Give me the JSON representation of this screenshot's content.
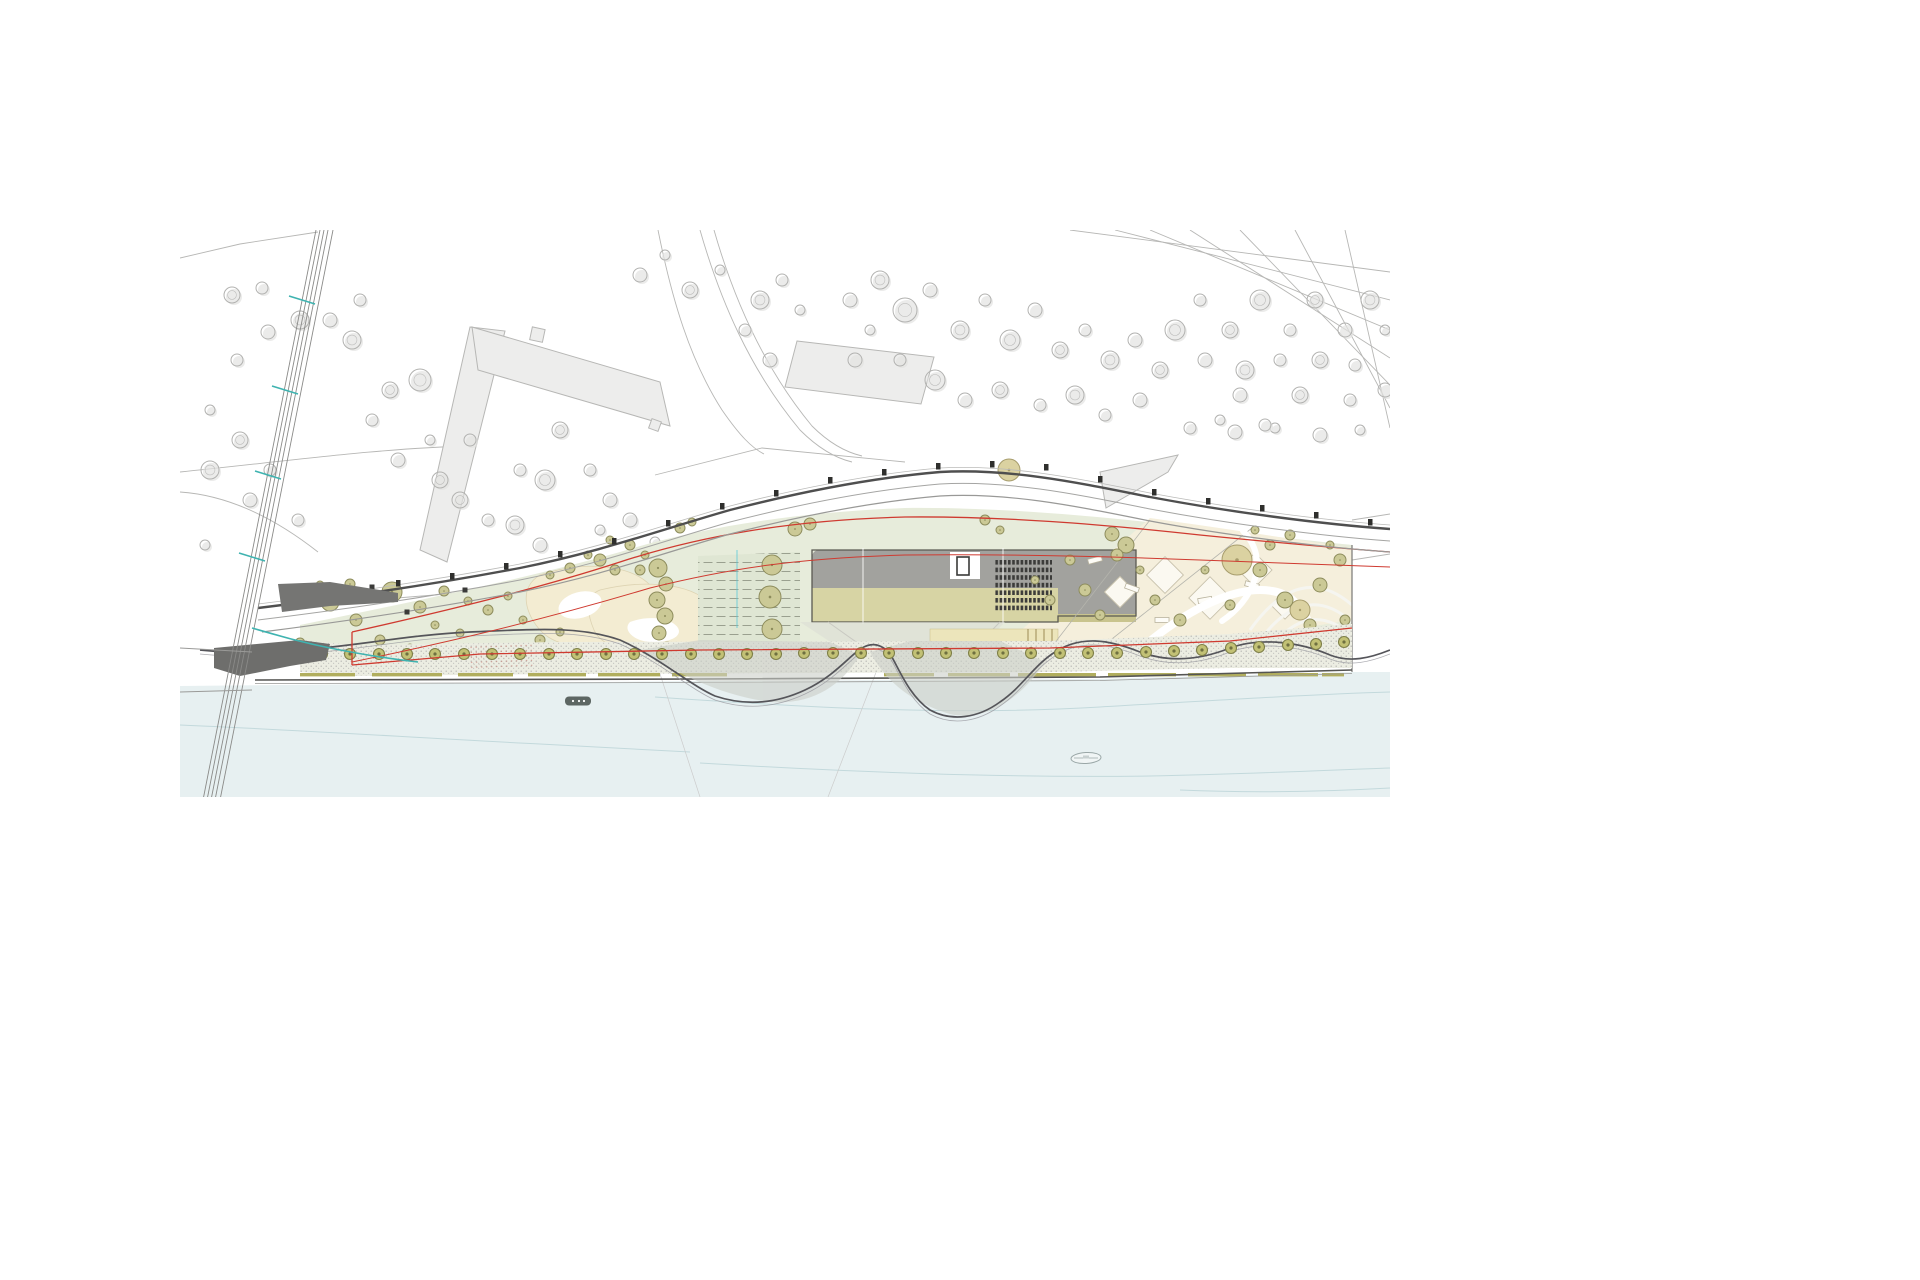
{
  "drawing": {
    "kind_label": "riverfront-park-site-plan",
    "palette": {
      "bg": "#ffffff",
      "water": "#e7f0f1",
      "waterline": "#c3d9dc",
      "green": "#e7ecdb",
      "green2": "#dfe6d3",
      "cream": "#f5efdc",
      "blob": "#f3ecd2",
      "khaki": "#c9c48e",
      "khaki2": "#d7d4a4",
      "roof": "#a2a29e",
      "roofedge": "#5a5952",
      "hatch": "#3c3c3a",
      "ctx": "#ededec",
      "ctxstroke": "#b7b7b5",
      "ctxtree": "#b2b2b0",
      "ctxtreeshadow": "#e3e3e1",
      "road": "#4f4f4f",
      "roadlight": "#a5a5a3",
      "red": "#cf3a30",
      "teal": "#3fb3b0",
      "olive": "#cbc996",
      "olivestroke": "#8d8c5c",
      "tan": "#dbd2a1",
      "tanstroke": "#a79d6d",
      "prom": "#ecede2",
      "promtree": "#c2c175",
      "promtreestroke": "#7f8049",
      "stippledot": "#acacaa",
      "dark": "#6e6e6c",
      "quaydash": "#b1ae5e",
      "rampgray": "#cbcec8",
      "yellowstrip": "#ece5bb"
    },
    "context_trees": [
      [
        232,
        295,
        8
      ],
      [
        262,
        288,
        6
      ],
      [
        300,
        320,
        9
      ],
      [
        268,
        332,
        7
      ],
      [
        237,
        360,
        6
      ],
      [
        210,
        410,
        5
      ],
      [
        240,
        440,
        8
      ],
      [
        270,
        470,
        6
      ],
      [
        210,
        470,
        9
      ],
      [
        250,
        500,
        7
      ],
      [
        298,
        520,
        6
      ],
      [
        205,
        545,
        5
      ],
      [
        330,
        320,
        7
      ],
      [
        360,
        300,
        6
      ],
      [
        352,
        340,
        9
      ],
      [
        390,
        390,
        8
      ],
      [
        420,
        380,
        11
      ],
      [
        372,
        420,
        6
      ],
      [
        398,
        460,
        7
      ],
      [
        430,
        440,
        5
      ],
      [
        460,
        500,
        8
      ],
      [
        488,
        520,
        6
      ],
      [
        515,
        525,
        9
      ],
      [
        540,
        545,
        7
      ],
      [
        560,
        430,
        8
      ],
      [
        590,
        470,
        6
      ],
      [
        610,
        500,
        7
      ],
      [
        545,
        480,
        10
      ],
      [
        520,
        470,
        6
      ],
      [
        600,
        530,
        5
      ],
      [
        630,
        520,
        7
      ],
      [
        655,
        542,
        5
      ],
      [
        470,
        440,
        6
      ],
      [
        440,
        480,
        8
      ],
      [
        640,
        275,
        7
      ],
      [
        665,
        255,
        5
      ],
      [
        690,
        290,
        8
      ],
      [
        720,
        270,
        5
      ],
      [
        760,
        300,
        9
      ],
      [
        782,
        280,
        6
      ],
      [
        745,
        330,
        6
      ],
      [
        770,
        360,
        7
      ],
      [
        800,
        310,
        5
      ],
      [
        850,
        300,
        7
      ],
      [
        880,
        280,
        9
      ],
      [
        905,
        310,
        12
      ],
      [
        930,
        290,
        7
      ],
      [
        960,
        330,
        9
      ],
      [
        985,
        300,
        6
      ],
      [
        1010,
        340,
        10
      ],
      [
        1035,
        310,
        7
      ],
      [
        1060,
        350,
        8
      ],
      [
        1085,
        330,
        6
      ],
      [
        1110,
        360,
        9
      ],
      [
        1135,
        340,
        7
      ],
      [
        1160,
        370,
        8
      ],
      [
        900,
        360,
        6
      ],
      [
        935,
        380,
        10
      ],
      [
        965,
        400,
        7
      ],
      [
        1000,
        390,
        8
      ],
      [
        1040,
        405,
        6
      ],
      [
        1075,
        395,
        9
      ],
      [
        1105,
        415,
        6
      ],
      [
        1140,
        400,
        7
      ],
      [
        870,
        330,
        5
      ],
      [
        855,
        360,
        7
      ],
      [
        1175,
        330,
        10
      ],
      [
        1200,
        300,
        6
      ],
      [
        1230,
        330,
        8
      ],
      [
        1260,
        300,
        10
      ],
      [
        1290,
        330,
        6
      ],
      [
        1315,
        300,
        8
      ],
      [
        1345,
        330,
        7
      ],
      [
        1370,
        300,
        9
      ],
      [
        1385,
        330,
        5
      ],
      [
        1205,
        360,
        7
      ],
      [
        1245,
        370,
        9
      ],
      [
        1280,
        360,
        6
      ],
      [
        1320,
        360,
        8
      ],
      [
        1355,
        365,
        6
      ],
      [
        1240,
        395,
        7
      ],
      [
        1300,
        395,
        8
      ],
      [
        1350,
        400,
        6
      ],
      [
        1385,
        390,
        7
      ],
      [
        1190,
        428,
        6
      ],
      [
        1235,
        432,
        7
      ],
      [
        1275,
        428,
        5
      ],
      [
        1320,
        435,
        7
      ],
      [
        1360,
        430,
        5
      ],
      [
        1220,
        420,
        5
      ],
      [
        1265,
        425,
        6
      ]
    ],
    "park_trees": [
      [
        330,
        602,
        9,
        "o"
      ],
      [
        356,
        620,
        6,
        "o"
      ],
      [
        392,
        592,
        10,
        "o"
      ],
      [
        420,
        607,
        6,
        "o"
      ],
      [
        300,
        643,
        5,
        "o"
      ],
      [
        444,
        591,
        5,
        "o"
      ],
      [
        468,
        601,
        4,
        "o"
      ],
      [
        350,
        584,
        5,
        "o"
      ],
      [
        320,
        585,
        4,
        "o"
      ],
      [
        435,
        625,
        4,
        "o"
      ],
      [
        460,
        633,
        4,
        "o"
      ],
      [
        488,
        610,
        5,
        "o"
      ],
      [
        508,
        596,
        4,
        "o"
      ],
      [
        523,
        620,
        4,
        "o"
      ],
      [
        380,
        640,
        5,
        "o"
      ],
      [
        410,
        648,
        4,
        "o"
      ],
      [
        658,
        568,
        9,
        "o"
      ],
      [
        666,
        584,
        7,
        "o"
      ],
      [
        657,
        600,
        8,
        "o"
      ],
      [
        665,
        616,
        8,
        "o"
      ],
      [
        659,
        633,
        7,
        "o"
      ],
      [
        667,
        648,
        6,
        "o"
      ],
      [
        649,
        652,
        4,
        "o"
      ],
      [
        676,
        654,
        4,
        "o"
      ],
      [
        640,
        570,
        5,
        "o"
      ],
      [
        645,
        555,
        4,
        "o"
      ],
      [
        772,
        565,
        10,
        "o"
      ],
      [
        770,
        597,
        11,
        "o"
      ],
      [
        772,
        629,
        10,
        "o"
      ],
      [
        758,
        650,
        4,
        "o"
      ],
      [
        746,
        648,
        4,
        "o"
      ],
      [
        783,
        650,
        4,
        "o"
      ],
      [
        795,
        529,
        7,
        "o"
      ],
      [
        810,
        524,
        6,
        "o"
      ],
      [
        680,
        528,
        5,
        "o"
      ],
      [
        692,
        522,
        4,
        "o"
      ],
      [
        540,
        640,
        5,
        "o"
      ],
      [
        560,
        632,
        4,
        "o"
      ],
      [
        600,
        560,
        6,
        "o"
      ],
      [
        615,
        570,
        5,
        "o"
      ],
      [
        588,
        555,
        4,
        "o"
      ],
      [
        630,
        545,
        5,
        "o"
      ],
      [
        610,
        540,
        4,
        "o"
      ],
      [
        570,
        568,
        5,
        "o"
      ],
      [
        550,
        575,
        4,
        "o"
      ],
      [
        1009,
        470,
        11,
        "t"
      ],
      [
        985,
        520,
        5,
        "o"
      ],
      [
        1000,
        530,
        4,
        "o"
      ],
      [
        1112,
        534,
        7,
        "o"
      ],
      [
        1126,
        545,
        8,
        "o"
      ],
      [
        1117,
        555,
        6,
        "o"
      ],
      [
        1070,
        560,
        5,
        "o"
      ],
      [
        1085,
        590,
        6,
        "o"
      ],
      [
        1100,
        615,
        5,
        "o"
      ],
      [
        1140,
        570,
        4,
        "o"
      ],
      [
        1155,
        600,
        5,
        "o"
      ],
      [
        1180,
        620,
        6,
        "o"
      ],
      [
        1205,
        570,
        4,
        "o"
      ],
      [
        1230,
        605,
        5,
        "o"
      ],
      [
        1237,
        560,
        15,
        "t"
      ],
      [
        1270,
        545,
        5,
        "o"
      ],
      [
        1300,
        610,
        10,
        "t"
      ],
      [
        1320,
        585,
        7,
        "o"
      ],
      [
        1260,
        570,
        7,
        "o"
      ],
      [
        1285,
        600,
        8,
        "o"
      ],
      [
        1310,
        625,
        6,
        "o"
      ],
      [
        1340,
        560,
        6,
        "o"
      ],
      [
        1345,
        620,
        5,
        "o"
      ],
      [
        1050,
        600,
        5,
        "o"
      ],
      [
        1035,
        580,
        4,
        "o"
      ],
      [
        1330,
        545,
        4,
        "o"
      ],
      [
        1255,
        530,
        4,
        "o"
      ],
      [
        1290,
        535,
        5,
        "o"
      ]
    ],
    "promenade_trees": [
      [
        322,
        654
      ],
      [
        350,
        654
      ],
      [
        379,
        654
      ],
      [
        407,
        654
      ],
      [
        435,
        654
      ],
      [
        464,
        654
      ],
      [
        492,
        654
      ],
      [
        520,
        654
      ],
      [
        549,
        654
      ],
      [
        577,
        654
      ],
      [
        606,
        654
      ],
      [
        634,
        654
      ],
      [
        662,
        654
      ],
      [
        691,
        654
      ],
      [
        719,
        654
      ],
      [
        747,
        654
      ],
      [
        776,
        654
      ],
      [
        804,
        653
      ],
      [
        833,
        653
      ],
      [
        861,
        653
      ],
      [
        889,
        653
      ],
      [
        918,
        653
      ],
      [
        946,
        653
      ],
      [
        974,
        653
      ],
      [
        1003,
        653
      ],
      [
        1031,
        653
      ],
      [
        1060,
        653
      ],
      [
        1088,
        653
      ],
      [
        1117,
        653
      ],
      [
        1146,
        652
      ],
      [
        1174,
        651
      ],
      [
        1202,
        650
      ],
      [
        1231,
        648
      ],
      [
        1259,
        647
      ],
      [
        1288,
        645
      ],
      [
        1316,
        644
      ],
      [
        1344,
        642
      ]
    ],
    "road_markers": [
      [
        398,
        588
      ],
      [
        452,
        581
      ],
      [
        506,
        571
      ],
      [
        560,
        559
      ],
      [
        614,
        546
      ],
      [
        668,
        528
      ],
      [
        722,
        511
      ],
      [
        776,
        498
      ],
      [
        830,
        485
      ],
      [
        884,
        477
      ],
      [
        938,
        471
      ],
      [
        992,
        469
      ],
      [
        1046,
        472
      ],
      [
        1100,
        484
      ],
      [
        1154,
        497
      ],
      [
        1208,
        506
      ],
      [
        1262,
        513
      ],
      [
        1316,
        520
      ],
      [
        1370,
        527
      ]
    ],
    "quay_dashes": [
      [
        300,
        55
      ],
      [
        372,
        70
      ],
      [
        458,
        55
      ],
      [
        528,
        58
      ],
      [
        598,
        62
      ],
      [
        672,
        55
      ],
      [
        884,
        50
      ],
      [
        948,
        62
      ],
      [
        1018,
        78
      ],
      [
        1108,
        68
      ],
      [
        1188,
        58
      ],
      [
        1258,
        60
      ],
      [
        1322,
        22
      ]
    ],
    "rail_ticks": [
      [
        302,
        300
      ],
      [
        285,
        390
      ],
      [
        268,
        475
      ],
      [
        252,
        557
      ]
    ],
    "street_furniture": [
      [
        320,
        602
      ],
      [
        372,
        587
      ],
      [
        407,
        612
      ],
      [
        465,
        590
      ]
    ],
    "plaza_diamonds": [
      [
        1120,
        592,
        22
      ],
      [
        1165,
        575,
        26
      ],
      [
        1210,
        598,
        30
      ],
      [
        1255,
        570,
        24
      ],
      [
        1285,
        605,
        20
      ]
    ],
    "plaza_benches": [
      [
        1095,
        560,
        -15
      ],
      [
        1132,
        588,
        20
      ],
      [
        1205,
        600,
        -10
      ],
      [
        1252,
        585,
        15
      ],
      [
        1162,
        620,
        0
      ]
    ],
    "boats": [
      {
        "x": 578,
        "y": 701,
        "w": 26,
        "h": 9,
        "style": "dark"
      },
      {
        "x": 1086,
        "y": 758,
        "w": 30,
        "h": 11,
        "style": "outline"
      }
    ]
  }
}
